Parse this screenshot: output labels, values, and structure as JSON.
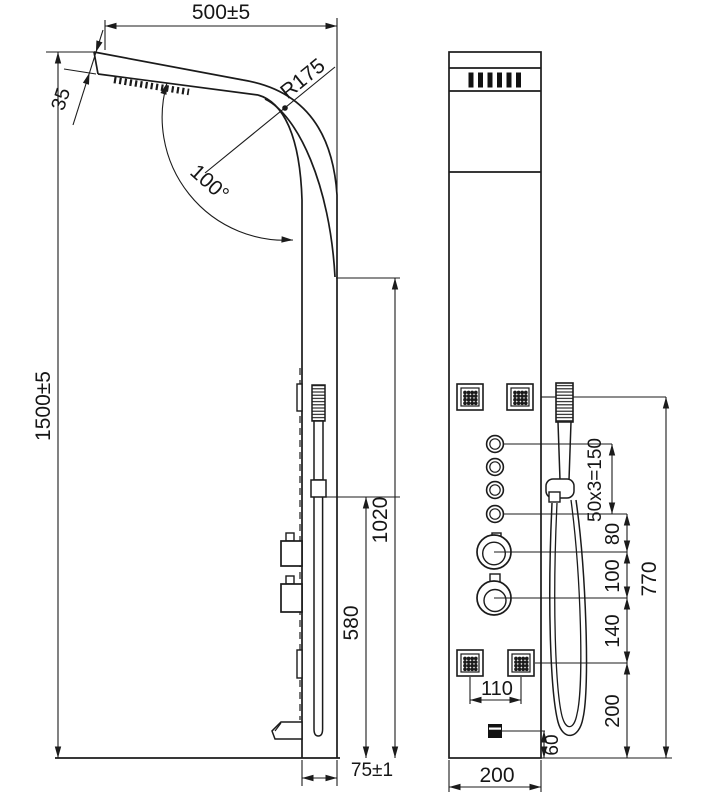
{
  "drawing": {
    "subject": "shower-panel-dimension-drawing",
    "background": "#ffffff",
    "line_color": "#1b1b1b",
    "dims": {
      "top_width": "500±5",
      "head_thickness": "35",
      "bend_radius": "R175",
      "bend_angle": "100°",
      "overall_height": "1500±5",
      "body_height": "1020",
      "handshower_height": "580",
      "panel_depth": "75±1",
      "button_pitch": "50x3=150",
      "knob_offset": "80",
      "knob_pitch": "100",
      "jet_offset": "140",
      "controls_span": "770",
      "jet_pitch": "110",
      "spout_offset": "60",
      "bottom_jet_offset": "200",
      "panel_width": "200"
    }
  }
}
